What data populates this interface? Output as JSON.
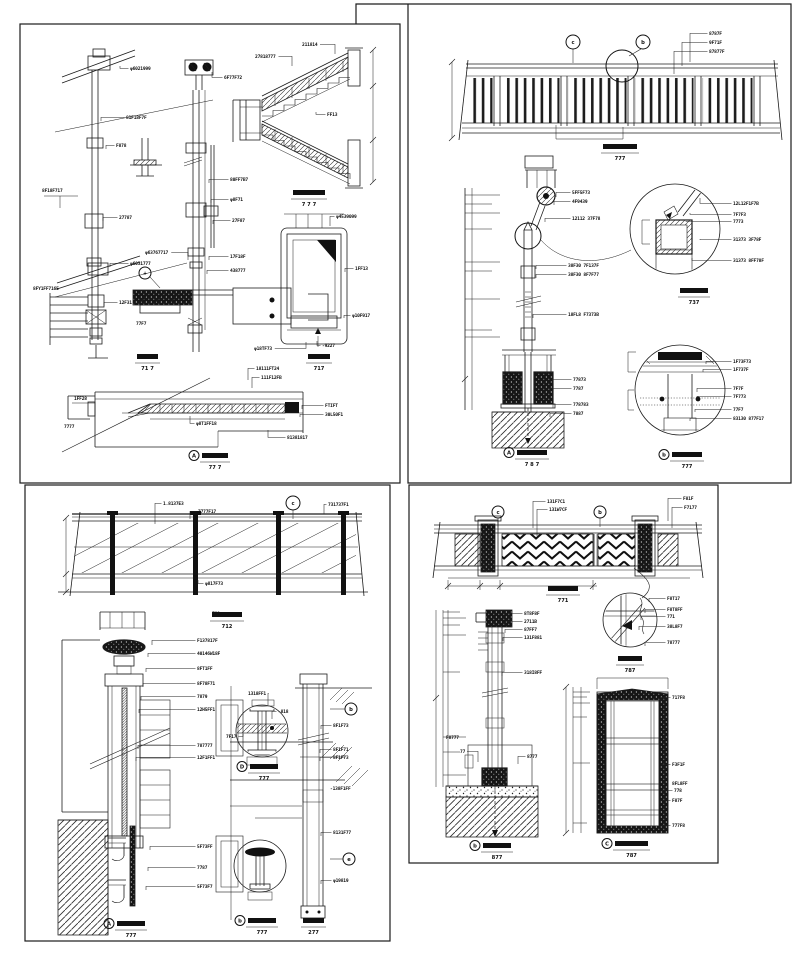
{
  "colors": {
    "ink": "#1c1c1c",
    "paper": "#ffffff"
  },
  "annotations": {
    "p1": {
      "labels": [
        {
          "t": "φ6021999",
          "x": 130,
          "y": 70,
          "lx": 120,
          "ly": 66
        },
        {
          "t": "81F18F7F",
          "x": 126,
          "y": 119,
          "lx": 101,
          "ly": 121
        },
        {
          "t": "F878",
          "x": 116,
          "y": 147,
          "lx": 106,
          "ly": 149
        },
        {
          "t": "8F18F717",
          "x": 42,
          "y": 192
        },
        {
          "t": "27787",
          "x": 119,
          "y": 219,
          "lx": 103,
          "ly": 221
        },
        {
          "t": "φ6031777",
          "x": 130,
          "y": 265,
          "lx": 110,
          "ly": 267
        },
        {
          "t": "8FY1FF716E",
          "x": 33,
          "y": 290
        },
        {
          "t": "12F31",
          "x": 119,
          "y": 304,
          "lx": 104,
          "ly": 306
        },
        {
          "t": "77F7",
          "x": 136,
          "y": 325
        },
        {
          "t": "6F77F72",
          "x": 224,
          "y": 79,
          "lx": 212,
          "ly": 72
        },
        {
          "t": "80FF7B7",
          "x": 230,
          "y": 181,
          "lx": 209,
          "ly": 183
        },
        {
          "t": "φ8F71",
          "x": 230,
          "y": 201,
          "lx": 211,
          "ly": 203
        },
        {
          "t": "27F87",
          "x": 232,
          "y": 222,
          "lx": 213,
          "ly": 224
        },
        {
          "t": "φ63767717",
          "x": 145,
          "y": 254,
          "lx": 188,
          "ly": 260
        },
        {
          "t": "17F18F",
          "x": 230,
          "y": 258,
          "lx": 209,
          "ly": 260
        },
        {
          "t": "438777",
          "x": 230,
          "y": 272,
          "lx": 207,
          "ly": 274
        },
        {
          "t": "211814",
          "x": 302,
          "y": 46,
          "lx": 335,
          "ly": 54
        },
        {
          "t": "27818777",
          "x": 255,
          "y": 58,
          "lx": 292,
          "ly": 66
        },
        {
          "t": "FF13",
          "x": 327,
          "y": 116,
          "lx": 316,
          "ly": 112
        },
        {
          "t": "φ4539099",
          "x": 336,
          "y": 218,
          "lx": 330,
          "ly": 226
        },
        {
          "t": "1FF13",
          "x": 355,
          "y": 270,
          "lx": 345,
          "ly": 272
        },
        {
          "t": "φ10F917",
          "x": 352,
          "y": 317,
          "lx": 344,
          "ly": 318
        },
        {
          "t": "φ18TF73",
          "x": 254,
          "y": 350,
          "lx": 306,
          "ly": 342
        },
        {
          "t": "-9227",
          "x": 322,
          "y": 347,
          "lx": 317,
          "ly": 341
        },
        {
          "t": "18111FT24",
          "x": 256,
          "y": 370,
          "lx": 248,
          "ly": 380
        },
        {
          "t": "111F12FB",
          "x": 261,
          "y": 379,
          "lx": 252,
          "ly": 388
        },
        {
          "t": "FTIFT",
          "x": 325,
          "y": 407,
          "lx": 302,
          "ly": 409
        },
        {
          "t": "30L50F1",
          "x": 325,
          "y": 416,
          "lx": 300,
          "ly": 417
        },
        {
          "t": "φ8T1FF18",
          "x": 196,
          "y": 425,
          "lx": 190,
          "ly": 416
        },
        {
          "t": "81381817",
          "x": 287,
          "y": 439,
          "lx": 268,
          "ly": 430
        },
        {
          "t": "1FF28",
          "x": 74,
          "y": 400
        },
        {
          "t": "7777",
          "x": 64,
          "y": 428
        }
      ],
      "titles": [
        {
          "x": 293,
          "y": 190,
          "w": 32,
          "s": "7 7 7"
        },
        {
          "x": 137,
          "y": 354,
          "w": 21,
          "s": "71 7"
        },
        {
          "x": 308,
          "y": 354,
          "w": 22,
          "s": "717"
        },
        {
          "x": 202,
          "y": 453,
          "w": 26,
          "s": "77 7",
          "c": "A"
        }
      ],
      "callouts": [
        {
          "x": 145,
          "y": 273,
          "r": 6,
          "t": "+",
          "sx": 150,
          "sy": 277,
          "ex": 160,
          "ey": 288
        }
      ]
    },
    "p2": {
      "labels": [
        {
          "t": "8787F",
          "x": 709,
          "y": 35,
          "lx": 690,
          "ly": 62
        },
        {
          "t": "9F71F",
          "x": 709,
          "y": 44,
          "lx": 682,
          "ly": 66
        },
        {
          "t": "87877F",
          "x": 709,
          "y": 53,
          "lx": 674,
          "ly": 74
        },
        {
          "t": "5FF5F73",
          "x": 572,
          "y": 194,
          "lx": 556,
          "ly": 197
        },
        {
          "t": "4F9439",
          "x": 572,
          "y": 203,
          "lx": 554,
          "ly": 205
        },
        {
          "t": "12112 37F78",
          "x": 572,
          "y": 220,
          "lx": 545,
          "ly": 222
        },
        {
          "t": "38F30 7F137F",
          "x": 568,
          "y": 267,
          "lx": 536,
          "ly": 269
        },
        {
          "t": "38F30 8F7F77",
          "x": 568,
          "y": 276,
          "lx": 536,
          "ly": 278
        },
        {
          "t": "18FL8 F7373B",
          "x": 568,
          "y": 316,
          "lx": 533,
          "ly": 318
        },
        {
          "t": "77873",
          "x": 573,
          "y": 381,
          "lx": 552,
          "ly": 383
        },
        {
          "t": "7787",
          "x": 573,
          "y": 390,
          "lx": 550,
          "ly": 392
        },
        {
          "t": "778783",
          "x": 573,
          "y": 406,
          "lx": 553,
          "ly": 408
        },
        {
          "t": "7887",
          "x": 573,
          "y": 415,
          "lx": 550,
          "ly": 417
        },
        {
          "t": "12L12F1F7B",
          "x": 733,
          "y": 205,
          "lx": 700,
          "ly": 198
        },
        {
          "t": "7F7F3",
          "x": 733,
          "y": 216,
          "lx": 690,
          "ly": 213
        },
        {
          "t": "7773",
          "x": 733,
          "y": 223,
          "lx": 686,
          "ly": 221
        },
        {
          "t": "31373 3F78F",
          "x": 733,
          "y": 241,
          "lx": 700,
          "ly": 240
        },
        {
          "t": "31373 8FF78F",
          "x": 733,
          "y": 262,
          "lx": 692,
          "ly": 258
        },
        {
          "t": "1F73F73",
          "x": 733,
          "y": 363,
          "lx": 706,
          "ly": 364
        },
        {
          "t": "1F737F",
          "x": 733,
          "y": 371,
          "lx": 703,
          "ly": 372
        },
        {
          "t": "7F7F",
          "x": 733,
          "y": 390,
          "lx": 697,
          "ly": 392
        },
        {
          "t": "7F773",
          "x": 733,
          "y": 398,
          "lx": 697,
          "ly": 400
        },
        {
          "t": "77F7",
          "x": 733,
          "y": 411,
          "lx": 695,
          "ly": 412
        },
        {
          "t": "83130 877F17",
          "x": 733,
          "y": 420,
          "lx": 690,
          "ly": 421
        }
      ],
      "titles": [
        {
          "x": 603,
          "y": 144,
          "w": 34,
          "s": "777"
        },
        {
          "x": 517,
          "y": 450,
          "w": 30,
          "s": "7 8 7",
          "c": "A"
        },
        {
          "x": 680,
          "y": 288,
          "w": 28,
          "s": "737"
        },
        {
          "x": 672,
          "y": 452,
          "w": 30,
          "s": "777",
          "c": "b"
        }
      ],
      "callouts": [
        {
          "x": 573,
          "y": 42,
          "r": 7,
          "t": "c",
          "sx": 573,
          "sy": 49,
          "ex": 573,
          "ey": 63
        },
        {
          "x": 643,
          "y": 42,
          "r": 7,
          "t": "b",
          "sx": 641,
          "sy": 49,
          "ex": 629,
          "ey": 56
        },
        {
          "x": 622,
          "y": 66,
          "r": 16,
          "t": ""
        },
        {
          "x": 528,
          "y": 236,
          "r": 13,
          "t": ""
        }
      ]
    },
    "p3": {
      "labels": [
        {
          "t": "1.8137E3",
          "x": 163,
          "y": 505,
          "lx": 155,
          "ly": 524
        },
        {
          "t": "7777F17",
          "x": 198,
          "y": 513,
          "lx": 190,
          "ly": 519
        },
        {
          "t": "731737F1",
          "x": 328,
          "y": 506,
          "lx": 324,
          "ly": 514
        },
        {
          "t": "φ817F73",
          "x": 205,
          "y": 585,
          "lx": 198,
          "ly": 580
        },
        {
          "t": "F137817F",
          "x": 197,
          "y": 642,
          "lx": 152,
          "ly": 645
        },
        {
          "t": "40146W18F",
          "x": 197,
          "y": 655,
          "lx": 148,
          "ly": 657
        },
        {
          "t": "8FT1FF",
          "x": 197,
          "y": 670,
          "lx": 146,
          "ly": 672
        },
        {
          "t": "8F78F71",
          "x": 197,
          "y": 685,
          "lx": 143,
          "ly": 687
        },
        {
          "t": "7879",
          "x": 197,
          "y": 698,
          "lx": 141,
          "ly": 700
        },
        {
          "t": "12H5FF1",
          "x": 197,
          "y": 711,
          "lx": 139,
          "ly": 713
        },
        {
          "t": "787777",
          "x": 197,
          "y": 747,
          "lx": 138,
          "ly": 749
        },
        {
          "t": "12F1FF1",
          "x": 197,
          "y": 759,
          "lx": 136,
          "ly": 761
        },
        {
          "t": "5F73FF",
          "x": 197,
          "y": 848,
          "lx": 150,
          "ly": 850
        },
        {
          "t": "7787",
          "x": 197,
          "y": 869,
          "lx": 148,
          "ly": 871
        },
        {
          "t": "5F73F7",
          "x": 197,
          "y": 888,
          "lx": 146,
          "ly": 890
        },
        {
          "t": "F88",
          "x": 212,
          "y": 615
        },
        {
          "t": "1318FF1",
          "x": 248,
          "y": 695,
          "lx": 268,
          "ly": 705
        },
        {
          "t": "-818",
          "x": 278,
          "y": 713,
          "lx": 272,
          "ly": 719
        },
        {
          "t": "7F17",
          "x": 226,
          "y": 738,
          "lx": 243,
          "ly": 734
        },
        {
          "t": "8F1F73",
          "x": 333,
          "y": 727,
          "lx": 321,
          "ly": 729
        },
        {
          "t": "8F1F71",
          "x": 333,
          "y": 751,
          "lx": 320,
          "ly": 753
        },
        {
          "t": "8F1F73",
          "x": 333,
          "y": 759,
          "lx": 320,
          "ly": 761
        },
        {
          "t": "-138F1FF",
          "x": 330,
          "y": 790
        },
        {
          "t": "8131F77",
          "x": 333,
          "y": 834,
          "lx": 321,
          "ly": 836
        },
        {
          "t": "φ19819",
          "x": 333,
          "y": 882,
          "lx": 321,
          "ly": 884
        }
      ],
      "titles": [
        {
          "x": 212,
          "y": 612,
          "w": 30,
          "s": "712"
        },
        {
          "x": 117,
          "y": 921,
          "w": 28,
          "s": "777",
          "c": "A"
        },
        {
          "x": 250,
          "y": 764,
          "w": 28,
          "s": "777",
          "c": "D"
        },
        {
          "x": 248,
          "y": 918,
          "w": 28,
          "s": "777",
          "c": "b"
        },
        {
          "x": 303,
          "y": 918,
          "w": 21,
          "s": "277"
        }
      ],
      "callouts": [
        {
          "x": 293,
          "y": 503,
          "r": 7,
          "t": "c",
          "sx": 293,
          "sy": 510,
          "ex": 293,
          "ey": 519
        },
        {
          "x": 351,
          "y": 709,
          "r": 6,
          "t": "b",
          "sx": 345,
          "sy": 709,
          "ex": 330,
          "ey": 709
        },
        {
          "x": 349,
          "y": 859,
          "r": 6,
          "t": "e",
          "sx": 343,
          "sy": 859,
          "ex": 330,
          "ey": 859
        }
      ]
    },
    "p4": {
      "labels": [
        {
          "t": "131F7C1",
          "x": 547,
          "y": 503,
          "lx": 533,
          "ly": 528
        },
        {
          "t": "131W7CF",
          "x": 549,
          "y": 511,
          "lx": 537,
          "ly": 536
        },
        {
          "t": "F81F",
          "x": 683,
          "y": 500,
          "lx": 668,
          "ly": 521
        },
        {
          "t": "F7177",
          "x": 684,
          "y": 509,
          "lx": 672,
          "ly": 528
        },
        {
          "t": "F8T17",
          "x": 667,
          "y": 600,
          "lx": 649,
          "ly": 602
        },
        {
          "t": "F8T8FF",
          "x": 667,
          "y": 611,
          "lx": 645,
          "ly": 613
        },
        {
          "t": "771",
          "x": 667,
          "y": 618,
          "lx": 641,
          "ly": 620
        },
        {
          "t": "38L8F7",
          "x": 667,
          "y": 628,
          "lx": 639,
          "ly": 630
        },
        {
          "t": "78777",
          "x": 667,
          "y": 644,
          "lx": 645,
          "ly": 646
        },
        {
          "t": "8T8F8F",
          "x": 524,
          "y": 615,
          "lx": 508,
          "ly": 617
        },
        {
          "t": "2711B",
          "x": 524,
          "y": 623,
          "lx": 506,
          "ly": 625
        },
        {
          "t": "87FF7",
          "x": 524,
          "y": 631,
          "lx": 505,
          "ly": 633
        },
        {
          "t": "131F881",
          "x": 524,
          "y": 639,
          "lx": 503,
          "ly": 641
        },
        {
          "t": "318I8FF",
          "x": 524,
          "y": 674,
          "lx": 502,
          "ly": 676
        },
        {
          "t": "F8777",
          "x": 446,
          "y": 739
        },
        {
          "t": "77",
          "x": 460,
          "y": 753,
          "lx": 478,
          "ly": 762
        },
        {
          "t": "8777",
          "x": 527,
          "y": 758,
          "lx": 518,
          "ly": 764
        },
        {
          "t": "717F8",
          "x": 672,
          "y": 699,
          "lx": 661,
          "ly": 701
        },
        {
          "t": "F3F1F",
          "x": 672,
          "y": 766,
          "lx": 662,
          "ly": 768
        },
        {
          "t": "8FL8FF",
          "x": 672,
          "y": 785
        },
        {
          "t": "778",
          "x": 674,
          "y": 792,
          "lx": 662,
          "ly": 793
        },
        {
          "t": "F87F",
          "x": 672,
          "y": 802,
          "lx": 660,
          "ly": 804
        },
        {
          "t": "777F8",
          "x": 672,
          "y": 827,
          "lx": 662,
          "ly": 829
        }
      ],
      "titles": [
        {
          "x": 548,
          "y": 586,
          "w": 30,
          "s": "771"
        },
        {
          "x": 618,
          "y": 656,
          "w": 24,
          "s": "787"
        },
        {
          "x": 483,
          "y": 843,
          "w": 28,
          "s": "877",
          "c": "b"
        },
        {
          "x": 615,
          "y": 841,
          "w": 33,
          "s": "787",
          "c": "C"
        }
      ],
      "callouts": [
        {
          "x": 498,
          "y": 512,
          "r": 6,
          "t": "c",
          "sx": 498,
          "sy": 518,
          "ex": 498,
          "ey": 527
        },
        {
          "x": 600,
          "y": 512,
          "r": 6,
          "t": "b",
          "sx": 600,
          "sy": 518,
          "ex": 600,
          "ey": 527
        }
      ]
    }
  }
}
